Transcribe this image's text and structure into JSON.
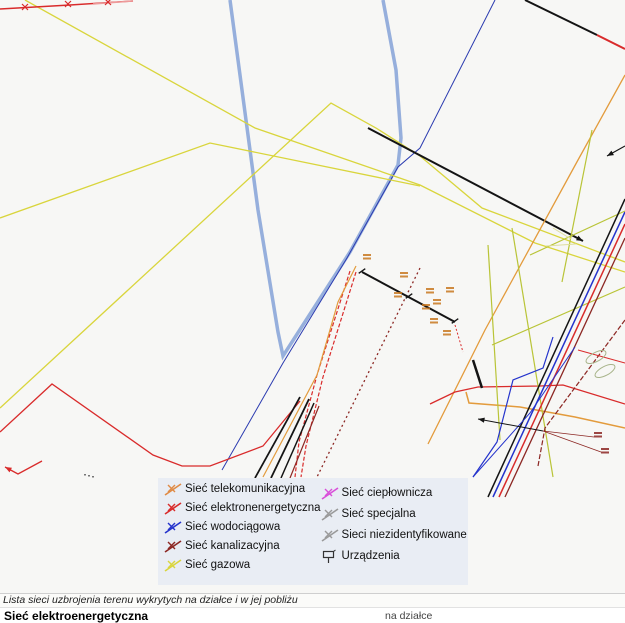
{
  "window": {
    "map_background": "#f7f7f5"
  },
  "legend": {
    "background": "#e9edf4",
    "columns": [
      {
        "items": [
          {
            "label": "Sieć telekomunikacyjna",
            "color": "#e08a44",
            "icon": "network-line"
          },
          {
            "label": "Sieć elektronenergetyczna",
            "color": "#d92b2b",
            "icon": "network-line"
          },
          {
            "label": "Sieć wodociągowa",
            "color": "#2433cc",
            "icon": "network-line"
          },
          {
            "label": "Sieć kanalizacyjna",
            "color": "#8c2723",
            "icon": "network-line"
          },
          {
            "label": "Sieć gazowa",
            "color": "#d9d53c",
            "icon": "network-line"
          }
        ]
      },
      {
        "items": [
          {
            "label": "Sieć ciepłownicza",
            "color": "#d94fd9",
            "icon": "network-line"
          },
          {
            "label": "Sieć specjalna",
            "color": "#9a9a9a",
            "icon": "network-line"
          },
          {
            "label": "Sieci niezidentyfikowane",
            "color": "#9a9a9a",
            "icon": "network-line"
          },
          {
            "label": "Urządzenia",
            "color": "#333333",
            "icon": "device"
          }
        ]
      }
    ]
  },
  "caption": "Lista sieci uzbrojenia terenu wykrytych na działce i w jej pobliżu",
  "results": {
    "first_network": "Sieć elektroenergetyczna",
    "column_header": "na działce"
  },
  "map": {
    "width": 625,
    "height": 593,
    "lines": [
      {
        "name": "parcel-boundary",
        "color": "#8ba6d9",
        "width": 3.5,
        "opacity": 0.9,
        "points": [
          [
            230,
            0
          ],
          [
            258,
            210
          ],
          [
            278,
            332
          ],
          [
            283,
            356
          ],
          [
            350,
            252
          ],
          [
            398,
            165
          ],
          [
            401,
            138
          ],
          [
            396,
            70
          ],
          [
            383,
            0
          ]
        ]
      },
      {
        "name": "water-main-line",
        "color": "#2b3bb0",
        "width": 1,
        "points": [
          [
            495,
            0
          ],
          [
            420,
            148
          ],
          [
            398,
            167
          ],
          [
            347,
            258
          ],
          [
            283,
            363
          ],
          [
            222,
            470
          ]
        ]
      },
      {
        "name": "gas-line-1",
        "color": "#d9d53c",
        "width": 1.3,
        "points": [
          [
            25,
            0
          ],
          [
            255,
            128
          ],
          [
            420,
            185
          ],
          [
            535,
            243
          ],
          [
            625,
            272
          ]
        ]
      },
      {
        "name": "gas-line-2",
        "color": "#d9d53c",
        "width": 1.3,
        "points": [
          [
            0,
            408
          ],
          [
            331,
            103
          ],
          [
            376,
            128
          ],
          [
            420,
            156
          ],
          [
            482,
            208
          ],
          [
            625,
            262
          ]
        ]
      },
      {
        "name": "gas-line-3",
        "color": "#d9d53c",
        "width": 1.3,
        "points": [
          [
            0,
            218
          ],
          [
            210,
            143
          ],
          [
            420,
            186
          ]
        ]
      },
      {
        "name": "power-line-main",
        "color": "#141414",
        "width": 2,
        "points": [
          [
            368,
            128
          ],
          [
            583,
            241
          ]
        ],
        "arrow": "end"
      },
      {
        "name": "power-line-topright",
        "color": "#141414",
        "width": 2,
        "points": [
          [
            525,
            0
          ],
          [
            597,
            35
          ]
        ]
      },
      {
        "name": "power-line-topright-red",
        "color": "#d92b2b",
        "width": 2,
        "points": [
          [
            597,
            35
          ],
          [
            625,
            49
          ]
        ]
      },
      {
        "name": "power-line-top",
        "color": "#d92b2b",
        "width": 1.4,
        "points": [
          [
            0,
            9
          ],
          [
            70,
            5
          ],
          [
            133,
            1
          ]
        ]
      },
      {
        "name": "power-line-top-light",
        "color": "#ee9a9a",
        "width": 1.4,
        "points": [
          [
            93,
            4
          ],
          [
            133,
            1
          ]
        ]
      },
      {
        "name": "power-line-west",
        "color": "#d92b2b",
        "width": 1.3,
        "points": [
          [
            0,
            432
          ],
          [
            52,
            384
          ],
          [
            153,
            455
          ],
          [
            182,
            466
          ],
          [
            210,
            466
          ],
          [
            263,
            446
          ],
          [
            300,
            401
          ]
        ]
      },
      {
        "name": "power-stub-west",
        "color": "#d92b2b",
        "width": 1.3,
        "points": [
          [
            42,
            461
          ],
          [
            18,
            474
          ],
          [
            5,
            467
          ]
        ],
        "arrow": "end"
      },
      {
        "name": "power-hatch-1",
        "color": "#d92b2b",
        "width": 1.2,
        "dash": "4,2",
        "points": [
          [
            350,
            271
          ],
          [
            317,
            375
          ],
          [
            299,
            442
          ],
          [
            295,
            477
          ]
        ]
      },
      {
        "name": "power-hatch-2",
        "color": "#d92b2b",
        "width": 1.2,
        "dash": "4,2",
        "points": [
          [
            356,
            272
          ],
          [
            323,
            377
          ],
          [
            306,
            446
          ],
          [
            301,
            477
          ]
        ]
      },
      {
        "name": "telecom-hatch",
        "color": "#e39b3c",
        "width": 1.2,
        "points": [
          [
            356,
            266
          ],
          [
            338,
            302
          ],
          [
            317,
            375
          ],
          [
            263,
            477
          ]
        ]
      },
      {
        "name": "power-cable-1",
        "color": "#141414",
        "width": 1.8,
        "points": [
          [
            300,
            397
          ],
          [
            255,
            478
          ]
        ]
      },
      {
        "name": "power-cable-2",
        "color": "#141414",
        "width": 1.8,
        "points": [
          [
            309,
            399
          ],
          [
            271,
            478
          ]
        ]
      },
      {
        "name": "power-cable-3",
        "color": "#141414",
        "width": 1.5,
        "points": [
          [
            314,
            403
          ],
          [
            281,
            478
          ]
        ]
      },
      {
        "name": "sewer-cable",
        "color": "#8c2723",
        "width": 1.2,
        "points": [
          [
            319,
            406
          ],
          [
            290,
            478
          ]
        ]
      },
      {
        "name": "sewer-dotted",
        "color": "#8c2723",
        "width": 1.3,
        "dash": "2,3",
        "points": [
          [
            420,
            268
          ],
          [
            317,
            477
          ]
        ]
      },
      {
        "name": "survey-line",
        "color": "#141414",
        "width": 2,
        "points": [
          [
            362,
            272
          ],
          [
            455,
            322
          ]
        ]
      },
      {
        "name": "survey-tail",
        "color": "#d92b2b",
        "width": 1,
        "dash": "2,2",
        "points": [
          [
            455,
            325
          ],
          [
            463,
            352
          ]
        ]
      },
      {
        "name": "telecom-line-long",
        "color": "#e39b3c",
        "width": 1.3,
        "points": [
          [
            625,
            75
          ],
          [
            578,
            160
          ],
          [
            485,
            330
          ],
          [
            428,
            444
          ]
        ]
      },
      {
        "name": "telecom-line-low",
        "color": "#e39b3c",
        "width": 1.5,
        "points": [
          [
            466,
            392
          ],
          [
            469,
            403
          ],
          [
            520,
            407
          ],
          [
            575,
            417
          ],
          [
            625,
            428
          ]
        ]
      },
      {
        "name": "power-line-mid",
        "color": "#d92b2b",
        "width": 1.3,
        "points": [
          [
            430,
            404
          ],
          [
            455,
            392
          ],
          [
            478,
            387
          ],
          [
            540,
            386
          ],
          [
            563,
            385
          ],
          [
            625,
            404
          ]
        ]
      },
      {
        "name": "green-line-1",
        "color": "#b9c437",
        "width": 1.2,
        "points": [
          [
            512,
            228
          ],
          [
            553,
            477
          ]
        ]
      },
      {
        "name": "green-line-2",
        "color": "#b9c437",
        "width": 1.2,
        "points": [
          [
            488,
            245
          ],
          [
            500,
            440
          ]
        ]
      },
      {
        "name": "green-line-3",
        "color": "#b9c437",
        "width": 1.2,
        "points": [
          [
            492,
            345
          ],
          [
            625,
            287
          ]
        ]
      },
      {
        "name": "green-line-4",
        "color": "#b9c437",
        "width": 1.2,
        "points": [
          [
            530,
            255
          ],
          [
            625,
            211
          ]
        ]
      },
      {
        "name": "green-line-5",
        "color": "#b9c437",
        "width": 1.2,
        "points": [
          [
            592,
            130
          ],
          [
            562,
            282
          ]
        ]
      },
      {
        "name": "bundle-black",
        "color": "#141414",
        "width": 1.5,
        "points": [
          [
            625,
            199
          ],
          [
            488,
            497
          ]
        ]
      },
      {
        "name": "bundle-blue",
        "color": "#2433cc",
        "width": 1.5,
        "points": [
          [
            625,
            212
          ],
          [
            493,
            497
          ]
        ]
      },
      {
        "name": "bundle-red",
        "color": "#d92b2b",
        "width": 1.5,
        "points": [
          [
            625,
            224
          ],
          [
            499,
            497
          ]
        ]
      },
      {
        "name": "bundle-darkred",
        "color": "#8c2723",
        "width": 1.3,
        "points": [
          [
            625,
            238
          ],
          [
            505,
            497
          ]
        ]
      },
      {
        "name": "water-zigzag",
        "color": "#2433cc",
        "width": 1.2,
        "points": [
          [
            553,
            337
          ],
          [
            543,
            368
          ],
          [
            513,
            380
          ],
          [
            497,
            442
          ],
          [
            473,
            477
          ]
        ]
      },
      {
        "name": "water-diagonal",
        "color": "#2433cc",
        "width": 1,
        "points": [
          [
            575,
            347
          ],
          [
            530,
            413
          ],
          [
            473,
            477
          ]
        ]
      },
      {
        "name": "sewer-dashed-east",
        "color": "#8c2723",
        "width": 1.2,
        "dash": "5,2",
        "points": [
          [
            625,
            320
          ],
          [
            545,
            428
          ],
          [
            538,
            466
          ]
        ]
      },
      {
        "name": "power-stub-east",
        "color": "#141414",
        "width": 2.5,
        "points": [
          [
            473,
            360
          ],
          [
            482,
            388
          ]
        ]
      },
      {
        "name": "arrow-line-east",
        "color": "#141414",
        "width": 1.2,
        "points": [
          [
            625,
            146
          ],
          [
            607,
            156
          ]
        ],
        "arrow": "end"
      },
      {
        "name": "arrow-line-south",
        "color": "#141414",
        "width": 1,
        "points": [
          [
            543,
            431
          ],
          [
            478,
            419
          ]
        ],
        "arrow": "end"
      },
      {
        "name": "label-leader-1",
        "color": "#8c2723",
        "width": 0.8,
        "points": [
          [
            543,
            431
          ],
          [
            594,
            437
          ]
        ]
      },
      {
        "name": "label-leader-2",
        "color": "#8c2723",
        "width": 0.8,
        "points": [
          [
            543,
            431
          ],
          [
            601,
            452
          ]
        ]
      },
      {
        "name": "power-line-ovals",
        "color": "#d92b2b",
        "width": 1,
        "points": [
          [
            578,
            350
          ],
          [
            625,
            363
          ]
        ]
      },
      {
        "name": "pale-mark-1",
        "color": "#dede9e",
        "width": 1,
        "points": [
          [
            546,
            246
          ],
          [
            576,
            244
          ]
        ]
      },
      {
        "name": "pale-mark-2",
        "color": "#dede9e",
        "width": 1,
        "points": [
          [
            553,
            228
          ],
          [
            571,
            239
          ]
        ]
      }
    ],
    "marks": [
      {
        "type": "x",
        "x": 25,
        "y": 7,
        "color": "#d92b2b"
      },
      {
        "type": "x",
        "x": 68,
        "y": 4,
        "color": "#d92b2b"
      },
      {
        "type": "x",
        "x": 108,
        "y": 2,
        "color": "#d92b2b"
      },
      {
        "type": "tick",
        "x": 362,
        "y": 271,
        "rot": 55,
        "color": "#141414"
      },
      {
        "type": "tick",
        "x": 409,
        "y": 296,
        "rot": 55,
        "color": "#141414"
      },
      {
        "type": "tick",
        "x": 455,
        "y": 321,
        "rot": 55,
        "color": "#141414"
      },
      {
        "type": "dots",
        "x": 84,
        "y": 474,
        "color": "#777777"
      }
    ],
    "ellipses": [
      {
        "cx": 596,
        "cy": 357,
        "rx": 11,
        "ry": 4.5,
        "rot": -28,
        "color": "#a8b48a"
      },
      {
        "cx": 605,
        "cy": 371,
        "rx": 11,
        "ry": 4.5,
        "rot": -28,
        "color": "#a8b48a"
      }
    ],
    "micro_labels": [
      {
        "x": 363,
        "y": 254,
        "color": "#c87820"
      },
      {
        "x": 400,
        "y": 272,
        "color": "#c87820"
      },
      {
        "x": 426,
        "y": 288,
        "color": "#c87820"
      },
      {
        "x": 433,
        "y": 299,
        "color": "#c87820"
      },
      {
        "x": 394,
        "y": 292,
        "color": "#c87820"
      },
      {
        "x": 430,
        "y": 318,
        "color": "#c87820"
      },
      {
        "x": 443,
        "y": 330,
        "color": "#c87820"
      },
      {
        "x": 446,
        "y": 287,
        "color": "#c87820"
      },
      {
        "x": 422,
        "y": 304,
        "color": "#c87820"
      },
      {
        "x": 594,
        "y": 432,
        "color": "#8c2723"
      },
      {
        "x": 601,
        "y": 448,
        "color": "#8c2723"
      }
    ]
  }
}
